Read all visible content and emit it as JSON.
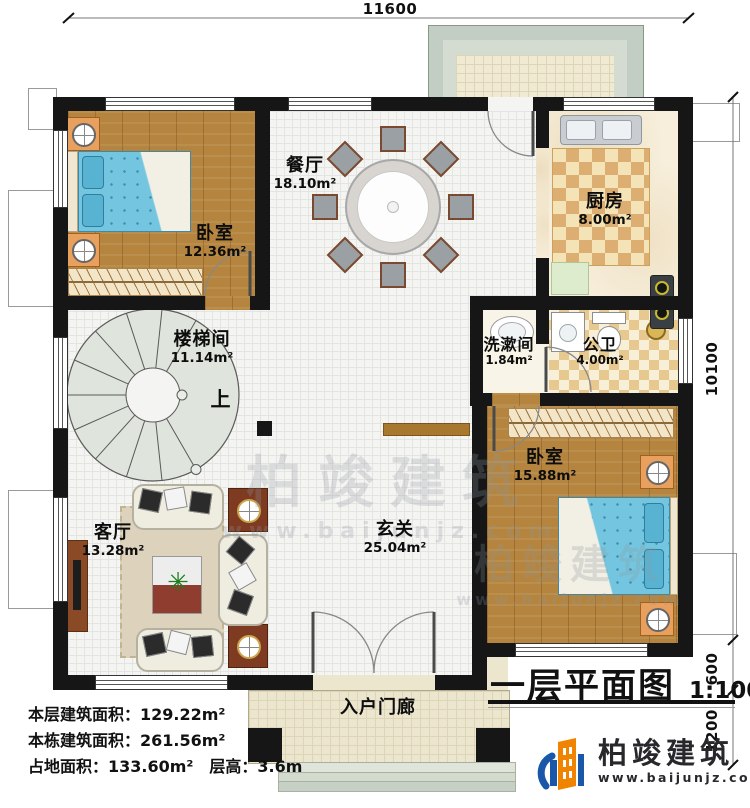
{
  "meta": {
    "title": "一层平面图",
    "scale": "1:100"
  },
  "dimensions": {
    "top": "11600",
    "right_total": "10100",
    "right_step": "600",
    "right_porch": "1200"
  },
  "rooms": {
    "bedroom1": {
      "name": "卧室",
      "area": "12.36m²"
    },
    "dining": {
      "name": "餐厅",
      "area": "18.10m²"
    },
    "kitchen": {
      "name": "厨房",
      "area": "8.00m²"
    },
    "stairwell": {
      "name": "楼梯间",
      "area": "11.14m²"
    },
    "washroom": {
      "name": "洗漱间",
      "area": "1.84m²"
    },
    "bathroom": {
      "name": "公卫",
      "area": "4.00m²"
    },
    "bedroom2": {
      "name": "卧室",
      "area": "15.88m²"
    },
    "living": {
      "name": "客厅",
      "area": "13.28m²"
    },
    "foyer": {
      "name": "玄关",
      "area": "25.04m²"
    },
    "porch": {
      "name": "入户门廊"
    }
  },
  "stair": {
    "up_label": "上"
  },
  "stats": {
    "line1": "本层建筑面积：129.22m²",
    "line2": "本栋建筑面积：261.56m²",
    "line3": "占地面积：133.60m²　层高：3.6m"
  },
  "branding": {
    "company": "柏竣建筑",
    "website": "www.baijunjz.com"
  },
  "watermark": {
    "text": "柏竣建筑",
    "subtext": "www.baijunjz.com"
  },
  "colors": {
    "wall": "#161616",
    "wood": "#b5853f",
    "accent_orange": "#f08300",
    "accent_blue": "#1a57a8"
  }
}
